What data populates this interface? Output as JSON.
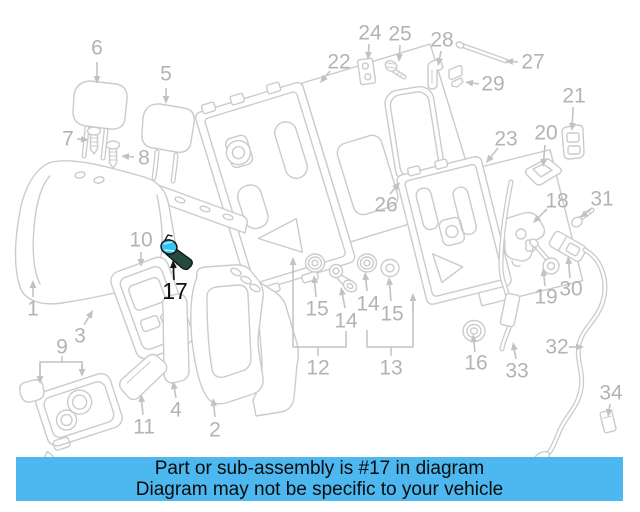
{
  "page": {
    "background": "#ffffff"
  },
  "banner": {
    "line1": "Part or sub-assembly is #17 in diagram",
    "line2": "Diagram may not be specific to your vehicle",
    "background": "#4cb8ef",
    "text_color": "#0b0b0b"
  },
  "highlight": {
    "part_number": "17",
    "fill_color": "#36c3ef",
    "accent_color": "#254b3c",
    "outline_color": "#111111",
    "label_color": "#111111"
  },
  "diagram": {
    "line_color": "#cbcbcb",
    "label_color": "#b3b3b3",
    "arrow_color": "#c2c2c2",
    "label_font_size": 21,
    "labels": [
      {
        "text": "6",
        "x": 97,
        "y": 48
      },
      {
        "text": "5",
        "x": 166,
        "y": 74
      },
      {
        "text": "7",
        "x": 68,
        "y": 139
      },
      {
        "text": "8",
        "x": 144,
        "y": 158
      },
      {
        "text": "1",
        "x": 33,
        "y": 309
      },
      {
        "text": "3",
        "x": 80,
        "y": 336
      },
      {
        "text": "9",
        "x": 62,
        "y": 347
      },
      {
        "text": "10",
        "x": 141,
        "y": 240
      },
      {
        "text": "17",
        "x": 175,
        "y": 291,
        "color": "#111111",
        "size": 23
      },
      {
        "text": "11",
        "x": 144,
        "y": 427
      },
      {
        "text": "4",
        "x": 176,
        "y": 410
      },
      {
        "text": "2",
        "x": 215,
        "y": 430
      },
      {
        "text": "22",
        "x": 339,
        "y": 62
      },
      {
        "text": "24",
        "x": 370,
        "y": 33
      },
      {
        "text": "25",
        "x": 400,
        "y": 34
      },
      {
        "text": "28",
        "x": 442,
        "y": 40
      },
      {
        "text": "27",
        "x": 533,
        "y": 62
      },
      {
        "text": "29",
        "x": 493,
        "y": 84
      },
      {
        "text": "21",
        "x": 574,
        "y": 96
      },
      {
        "text": "20",
        "x": 546,
        "y": 133
      },
      {
        "text": "23",
        "x": 506,
        "y": 139
      },
      {
        "text": "26",
        "x": 386,
        "y": 205
      },
      {
        "text": "18",
        "x": 557,
        "y": 201
      },
      {
        "text": "31",
        "x": 602,
        "y": 199
      },
      {
        "text": "19",
        "x": 546,
        "y": 297
      },
      {
        "text": "30",
        "x": 571,
        "y": 289
      },
      {
        "text": "15",
        "x": 317,
        "y": 309
      },
      {
        "text": "14",
        "x": 346,
        "y": 321
      },
      {
        "text": "14",
        "x": 368,
        "y": 304
      },
      {
        "text": "15",
        "x": 392,
        "y": 314
      },
      {
        "text": "12",
        "x": 318,
        "y": 368
      },
      {
        "text": "13",
        "x": 391,
        "y": 368
      },
      {
        "text": "16",
        "x": 476,
        "y": 363
      },
      {
        "text": "33",
        "x": 517,
        "y": 371
      },
      {
        "text": "32",
        "x": 557,
        "y": 347
      },
      {
        "text": "34",
        "x": 611,
        "y": 393
      }
    ],
    "arrows": [
      {
        "x1": 97,
        "y1": 62,
        "x2": 97,
        "y2": 84
      },
      {
        "x1": 166,
        "y1": 88,
        "x2": 166,
        "y2": 104
      },
      {
        "x1": 77,
        "y1": 139,
        "x2": 89,
        "y2": 140
      },
      {
        "x1": 134,
        "y1": 157,
        "x2": 121,
        "y2": 156
      },
      {
        "x1": 141,
        "y1": 252,
        "x2": 141,
        "y2": 267
      },
      {
        "x1": 33,
        "y1": 297,
        "x2": 33,
        "y2": 280
      },
      {
        "x1": 84,
        "y1": 325,
        "x2": 93,
        "y2": 310
      },
      {
        "x1": 40,
        "y1": 364,
        "x2": 40,
        "y2": 384
      },
      {
        "x1": 82,
        "y1": 364,
        "x2": 82,
        "y2": 377
      },
      {
        "x1": 143,
        "y1": 415,
        "x2": 141,
        "y2": 394
      },
      {
        "x1": 176,
        "y1": 398,
        "x2": 173,
        "y2": 381
      },
      {
        "x1": 215,
        "y1": 417,
        "x2": 213,
        "y2": 398
      },
      {
        "x1": 174,
        "y1": 280,
        "x2": 173,
        "y2": 260,
        "color": "#111111"
      },
      {
        "x1": 330,
        "y1": 71,
        "x2": 320,
        "y2": 83
      },
      {
        "x1": 369,
        "y1": 44,
        "x2": 368,
        "y2": 60
      },
      {
        "x1": 400,
        "y1": 45,
        "x2": 399,
        "y2": 62
      },
      {
        "x1": 441,
        "y1": 51,
        "x2": 438,
        "y2": 66
      },
      {
        "x1": 518,
        "y1": 62,
        "x2": 505,
        "y2": 61
      },
      {
        "x1": 479,
        "y1": 84,
        "x2": 465,
        "y2": 82
      },
      {
        "x1": 573,
        "y1": 107,
        "x2": 572,
        "y2": 131
      },
      {
        "x1": 545,
        "y1": 145,
        "x2": 543,
        "y2": 167
      },
      {
        "x1": 498,
        "y1": 148,
        "x2": 486,
        "y2": 163
      },
      {
        "x1": 390,
        "y1": 194,
        "x2": 400,
        "y2": 182
      },
      {
        "x1": 547,
        "y1": 209,
        "x2": 533,
        "y2": 223
      },
      {
        "x1": 592,
        "y1": 208,
        "x2": 580,
        "y2": 218
      },
      {
        "x1": 545,
        "y1": 286,
        "x2": 543,
        "y2": 268
      },
      {
        "x1": 570,
        "y1": 278,
        "x2": 568,
        "y2": 256
      },
      {
        "x1": 316,
        "y1": 297,
        "x2": 314,
        "y2": 275
      },
      {
        "x1": 345,
        "y1": 308,
        "x2": 341,
        "y2": 287
      },
      {
        "x1": 367,
        "y1": 291,
        "x2": 365,
        "y2": 272
      },
      {
        "x1": 391,
        "y1": 301,
        "x2": 389,
        "y2": 277
      },
      {
        "x1": 293,
        "y1": 274,
        "x2": 293,
        "y2": 257
      },
      {
        "x1": 413,
        "y1": 312,
        "x2": 413,
        "y2": 293
      },
      {
        "x1": 475,
        "y1": 352,
        "x2": 473,
        "y2": 334
      },
      {
        "x1": 516,
        "y1": 359,
        "x2": 513,
        "y2": 342
      },
      {
        "x1": 569,
        "y1": 347,
        "x2": 584,
        "y2": 347
      },
      {
        "x1": 610,
        "y1": 404,
        "x2": 608,
        "y2": 417
      }
    ],
    "brackets": [
      [
        [
          62,
          356
        ],
        [
          62,
          362
        ]
      ],
      [
        [
          40,
          374
        ],
        [
          40,
          362
        ],
        [
          82,
          362
        ],
        [
          82,
          370
        ]
      ],
      [
        [
          293,
          270
        ],
        [
          293,
          347
        ],
        [
          346,
          347
        ],
        [
          346,
          331
        ]
      ],
      [
        [
          318,
          347
        ],
        [
          318,
          356
        ]
      ],
      [
        [
          367,
          330
        ],
        [
          367,
          347
        ],
        [
          413,
          347
        ],
        [
          413,
          305
        ]
      ],
      [
        [
          391,
          347
        ],
        [
          391,
          356
        ]
      ]
    ]
  }
}
